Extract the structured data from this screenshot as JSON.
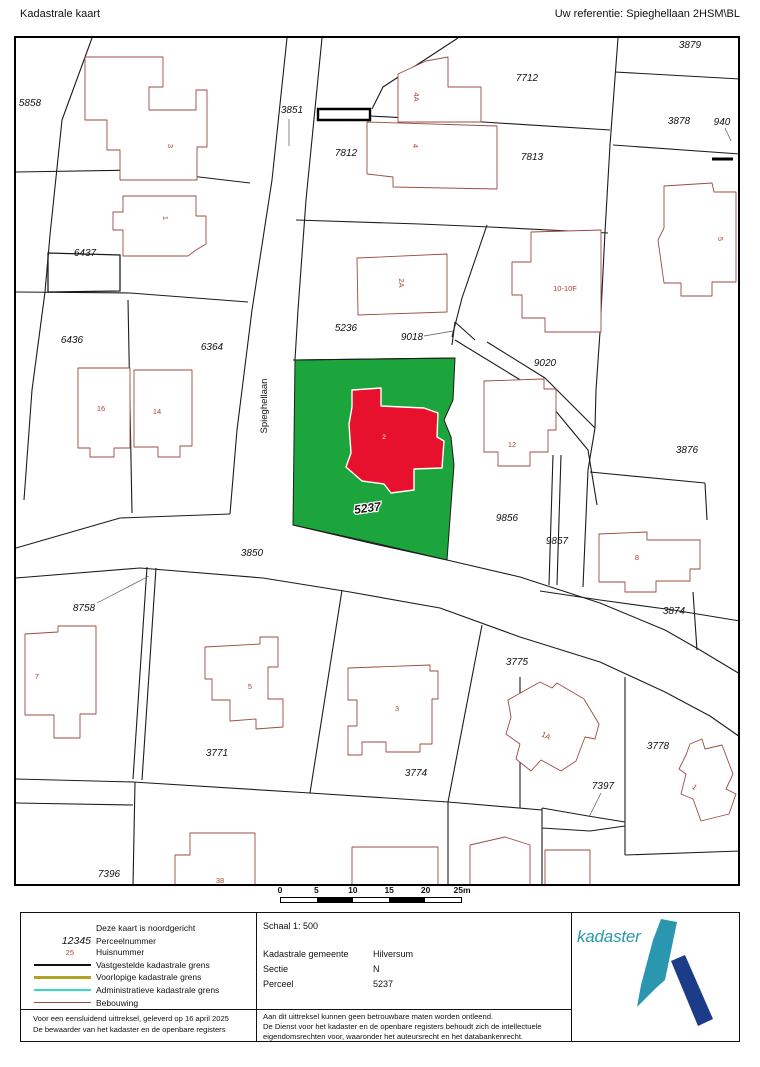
{
  "header": {
    "title": "Kadastrale kaart",
    "reference": "Uw referentie: Spieghellaan 2HSM\\BL"
  },
  "map": {
    "street_name": "Spieghellaan",
    "subject_parcel": {
      "number": "5237",
      "fill": "#1BA53C",
      "building_fill": "#E8112D",
      "building_label": "2"
    },
    "colors": {
      "parcel_line": "#1c1c1c",
      "building_line": "#9C4B40",
      "house_number": "#A8432F"
    },
    "parcel_labels": [
      {
        "t": "5858",
        "x": 30,
        "y": 106
      },
      {
        "t": "3851",
        "x": 292,
        "y": 113
      },
      {
        "t": "7812",
        "x": 346,
        "y": 156
      },
      {
        "t": "7712",
        "x": 527,
        "y": 81
      },
      {
        "t": "7813",
        "x": 532,
        "y": 160
      },
      {
        "t": "3879",
        "x": 690,
        "y": 48
      },
      {
        "t": "3878",
        "x": 679,
        "y": 124
      },
      {
        "t": "940",
        "x": 722,
        "y": 125
      },
      {
        "t": "6437",
        "x": 85,
        "y": 256
      },
      {
        "t": "6436",
        "x": 72,
        "y": 343
      },
      {
        "t": "6364",
        "x": 212,
        "y": 350
      },
      {
        "t": "5236",
        "x": 346,
        "y": 331
      },
      {
        "t": "9018",
        "x": 412,
        "y": 340
      },
      {
        "t": "9020",
        "x": 545,
        "y": 366
      },
      {
        "t": "3876",
        "x": 687,
        "y": 453
      },
      {
        "t": "9856",
        "x": 507,
        "y": 521
      },
      {
        "t": "9857",
        "x": 557,
        "y": 544
      },
      {
        "t": "3850",
        "x": 252,
        "y": 556
      },
      {
        "t": "8758",
        "x": 84,
        "y": 611
      },
      {
        "t": "3874",
        "x": 674,
        "y": 614
      },
      {
        "t": "3775",
        "x": 517,
        "y": 665
      },
      {
        "t": "3771",
        "x": 217,
        "y": 756
      },
      {
        "t": "3774",
        "x": 416,
        "y": 776
      },
      {
        "t": "7397",
        "x": 603,
        "y": 789
      },
      {
        "t": "3778",
        "x": 658,
        "y": 749
      },
      {
        "t": "7396",
        "x": 109,
        "y": 877
      }
    ],
    "house_labels": [
      {
        "t": "3",
        "x": 168,
        "y": 146,
        "r": 90
      },
      {
        "t": "1",
        "x": 163,
        "y": 218,
        "r": 90
      },
      {
        "t": "16",
        "x": 101,
        "y": 411
      },
      {
        "t": "14",
        "x": 157,
        "y": 414
      },
      {
        "t": "4A",
        "x": 414,
        "y": 97,
        "r": 90
      },
      {
        "t": "4",
        "x": 413,
        "y": 146,
        "r": 90
      },
      {
        "t": "2A",
        "x": 399,
        "y": 283,
        "r": 90
      },
      {
        "t": "5",
        "x": 718,
        "y": 239,
        "r": 90
      },
      {
        "t": "10-10F",
        "x": 565,
        "y": 291
      },
      {
        "t": "12",
        "x": 512,
        "y": 447
      },
      {
        "t": "8",
        "x": 637,
        "y": 560
      },
      {
        "t": "7",
        "x": 37,
        "y": 679
      },
      {
        "t": "5",
        "x": 250,
        "y": 689
      },
      {
        "t": "3",
        "x": 397,
        "y": 711
      },
      {
        "t": "1A",
        "x": 545,
        "y": 738,
        "r": 25
      },
      {
        "t": "1",
        "x": 693,
        "y": 789,
        "r": 40
      },
      {
        "t": "38",
        "x": 220,
        "y": 883
      }
    ],
    "scale_bar": {
      "labels": [
        "0",
        "5",
        "10",
        "15",
        "20",
        "25m"
      ]
    }
  },
  "legend": {
    "north_note": "Deze kaart is noordgericht",
    "items": [
      {
        "sample": "parcel-number",
        "sample_text": "12345",
        "label": "Perceelnummer"
      },
      {
        "sample": "house-number",
        "sample_text": "25",
        "label": "Huisnummer"
      },
      {
        "sample": "line-black",
        "label": "Vastgestelde kadastrale grens"
      },
      {
        "sample": "line-olive",
        "label": "Voorlopige kadastrale grens"
      },
      {
        "sample": "line-cyan",
        "label": "Administratieve kadastrale grens"
      },
      {
        "sample": "line-red",
        "label": "Bebouwing"
      }
    ],
    "scale": "Schaal 1: 500",
    "details": [
      {
        "label": "Kadastrale gemeente",
        "value": "Hilversum"
      },
      {
        "label": "Sectie",
        "value": "N"
      },
      {
        "label": "Perceel",
        "value": "5237"
      }
    ]
  },
  "footer": {
    "left": [
      "Voor een eensluidend uittreksel, geleverd op 16 april 2025",
      "De bewaarder van het kadaster en de openbare registers"
    ],
    "middle": [
      "Aan dit uittreksel kunnen geen betrouwbare maten worden ontleend.",
      "De Dienst voor het kadaster en de openbare registers behoudt zich de intellectuele",
      "eigendomsrechten voor, waaronder het auteursrecht en het databankenrecht."
    ]
  },
  "logo": {
    "text": "kadaster",
    "teal": "#2A96B0",
    "blue": "#1C3C8A"
  }
}
